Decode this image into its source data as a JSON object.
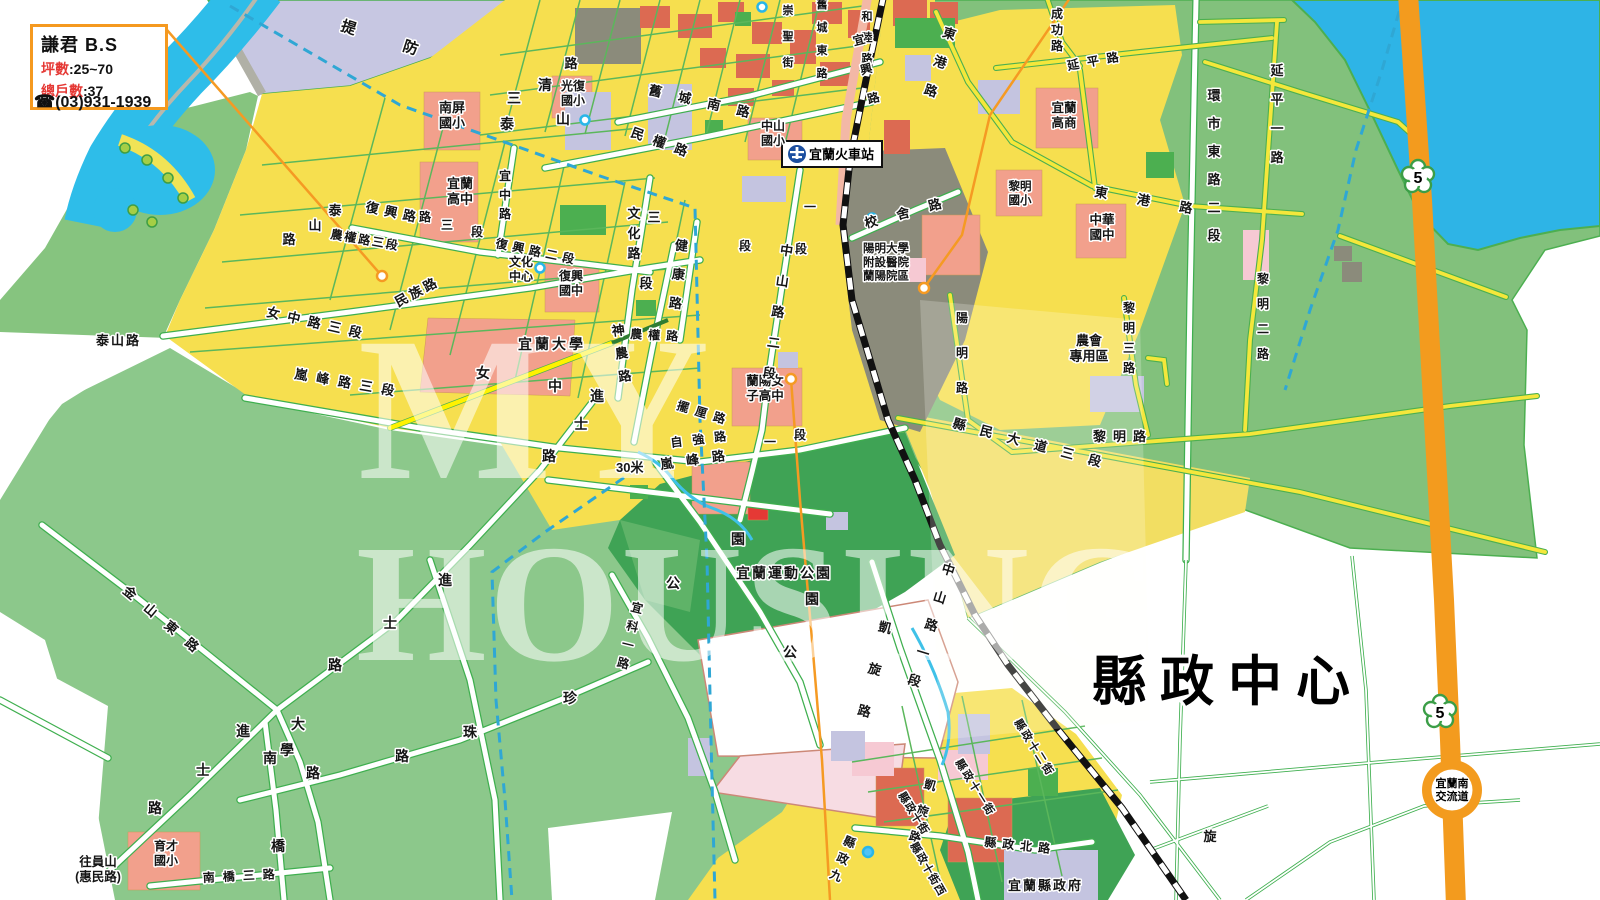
{
  "info_box": {
    "title": "謙君 B.S",
    "area_label": "坪數",
    "area_sep": ":",
    "area_value": "25~70",
    "units_label": "總戶數",
    "units_sep": ":",
    "units_value": "37",
    "phone_icon": "☎",
    "phone": "(03)931-1939"
  },
  "station": {
    "label": "宜蘭火車站"
  },
  "district_label": "縣政中心",
  "highway": {
    "number": "5",
    "interchange_line1": "宜蘭南",
    "interchange_line2": "交流道"
  },
  "watermark": {
    "line1": "MY",
    "line2": "HOUSING"
  },
  "colors": {
    "accent_orange": "#F5991F",
    "label_red": "#E53935",
    "water": "#2EBDE9",
    "field_green": "#8CC88B",
    "park_green": "#3FA355",
    "urban_yellow": "#F6DF4F",
    "school_red": "#DC6A52",
    "highway_orange": "#F39B1E"
  },
  "labels": [
    {
      "t": "提防",
      "x": 340,
      "y": 30,
      "s": 15,
      "a": 18,
      "sp": 50
    },
    {
      "t": "南屏\n國小",
      "x": 452,
      "y": 112,
      "s": 13,
      "an": "m"
    },
    {
      "t": "光復\n國小",
      "x": 573,
      "y": 90,
      "s": 12,
      "an": "m"
    },
    {
      "t": "清",
      "x": 545,
      "y": 90,
      "s": 14,
      "an": "m"
    },
    {
      "t": "路",
      "x": 571,
      "y": 68,
      "s": 13,
      "an": "m"
    },
    {
      "t": "三",
      "x": 514,
      "y": 103,
      "s": 14,
      "an": "m"
    },
    {
      "t": "泰",
      "x": 507,
      "y": 129,
      "s": 14,
      "an": "m"
    },
    {
      "t": "山",
      "x": 563,
      "y": 124,
      "s": 14,
      "an": "m"
    },
    {
      "t": "舊城南路",
      "x": 648,
      "y": 94,
      "a": 13,
      "sp": 17
    },
    {
      "t": "民權路",
      "x": 630,
      "y": 136,
      "a": 20,
      "sp": 10
    },
    {
      "t": "中山\n國小",
      "x": 773,
      "y": 130,
      "s": 12,
      "an": "m"
    },
    {
      "t": "崇聖街",
      "x": 788,
      "y": 14,
      "v": 1,
      "st": 26,
      "s": 11
    },
    {
      "t": "舊城東路",
      "x": 822,
      "y": 8,
      "v": 1,
      "st": 23,
      "s": 11
    },
    {
      "t": "和睦路",
      "x": 867,
      "y": 20,
      "v": 1,
      "st": 21,
      "s": 11
    },
    {
      "t": "宜興路",
      "x": 860,
      "y": 44,
      "v": 1,
      "st": 30,
      "s": 12,
      "a": -14
    },
    {
      "t": "東港路",
      "x": 948,
      "y": 38,
      "v": 1,
      "st": 30,
      "s": 13,
      "a": 18
    },
    {
      "t": "成功路",
      "x": 1057,
      "y": 18,
      "v": 1,
      "st": 16,
      "s": 12
    },
    {
      "t": "延平路",
      "x": 1068,
      "y": 70,
      "a": -10,
      "sp": 8,
      "s": 12
    },
    {
      "t": "宜蘭\n高商",
      "x": 1064,
      "y": 112,
      "s": 12.5,
      "an": "m"
    },
    {
      "t": "黎明\n國小",
      "x": 1020,
      "y": 190,
      "s": 11.5,
      "an": "m"
    },
    {
      "t": "中華\n國中",
      "x": 1102,
      "y": 224,
      "s": 12.5,
      "an": "m"
    },
    {
      "t": "東港路",
      "x": 1094,
      "y": 196,
      "a": 10,
      "sp": 30
    },
    {
      "t": "環市東路二段",
      "x": 1214,
      "y": 100,
      "v": 1,
      "st": 28,
      "s": 13
    },
    {
      "t": "延平一路",
      "x": 1277,
      "y": 75,
      "v": 1,
      "st": 29,
      "s": 13
    },
    {
      "t": "黎明二路",
      "x": 1263,
      "y": 283,
      "v": 1,
      "st": 25,
      "s": 12
    },
    {
      "t": "黎明三路",
      "x": 1129,
      "y": 312,
      "v": 1,
      "st": 20,
      "s": 12
    },
    {
      "t": "農會\n專用區",
      "x": 1089,
      "y": 345,
      "s": 13,
      "an": "m"
    },
    {
      "t": "陽明路",
      "x": 962,
      "y": 322,
      "v": 1,
      "st": 35,
      "s": 12
    },
    {
      "t": "校舍路",
      "x": 866,
      "y": 228,
      "a": -15,
      "sp": 20
    },
    {
      "t": "陽明大學\n附設醫院\n蘭陽院區",
      "x": 886,
      "y": 252,
      "s": 11.5,
      "an": "m"
    },
    {
      "t": "縣民大道三段",
      "x": 952,
      "y": 427,
      "a": 15,
      "sp": 15
    },
    {
      "t": "黎明路",
      "x": 1093,
      "y": 441,
      "sp": 7
    },
    {
      "t": "宜蘭\n高中",
      "x": 460,
      "y": 188,
      "s": 13,
      "an": "m"
    },
    {
      "t": "路",
      "x": 425,
      "y": 221,
      "s": 12,
      "an": "m"
    },
    {
      "t": "三",
      "x": 447,
      "y": 229,
      "s": 12,
      "an": "m"
    },
    {
      "t": "段",
      "x": 477,
      "y": 236,
      "s": 12,
      "an": "m"
    },
    {
      "t": "宜中路",
      "x": 505,
      "y": 180,
      "v": 1,
      "st": 19,
      "s": 12
    },
    {
      "t": "復興路",
      "x": 365,
      "y": 211,
      "a": 12,
      "sp": 6
    },
    {
      "t": "泰",
      "x": 335,
      "y": 215,
      "s": 13,
      "an": "m"
    },
    {
      "t": "山",
      "x": 315,
      "y": 230,
      "s": 13,
      "an": "m"
    },
    {
      "t": "路",
      "x": 289,
      "y": 244,
      "s": 13,
      "an": "m"
    },
    {
      "t": "農權路三段",
      "x": 330,
      "y": 238,
      "a": 10,
      "sp": 2,
      "s": 12
    },
    {
      "t": "民族路",
      "x": 398,
      "y": 307,
      "a": -28,
      "sp": 3
    },
    {
      "t": "女中路三段",
      "x": 266,
      "y": 316,
      "a": 13,
      "sp": 8
    },
    {
      "t": "嵐峰路三段",
      "x": 294,
      "y": 378,
      "a": 10,
      "sp": 9
    },
    {
      "t": "女",
      "x": 483,
      "y": 378,
      "s": 14,
      "an": "m"
    },
    {
      "t": "中",
      "x": 555,
      "y": 391,
      "s": 14,
      "an": "m"
    },
    {
      "t": "進",
      "x": 597,
      "y": 401,
      "s": 14,
      "an": "m"
    },
    {
      "t": "士",
      "x": 581,
      "y": 429,
      "s": 14,
      "an": "m"
    },
    {
      "t": "路",
      "x": 549,
      "y": 461,
      "s": 14,
      "an": "m"
    },
    {
      "t": "文化\n中心",
      "x": 521,
      "y": 266,
      "s": 12,
      "an": "m"
    },
    {
      "t": "復興\n國中",
      "x": 571,
      "y": 280,
      "s": 12,
      "an": "m"
    },
    {
      "t": "復興路二段",
      "x": 495,
      "y": 247,
      "a": 12,
      "sp": 5,
      "s": 12
    },
    {
      "t": "文化路",
      "x": 634,
      "y": 218,
      "v": 1,
      "st": 20,
      "s": 13
    },
    {
      "t": "三",
      "x": 654,
      "y": 222,
      "s": 13,
      "an": "m"
    },
    {
      "t": "段",
      "x": 646,
      "y": 288,
      "s": 13,
      "an": "m"
    },
    {
      "t": "健康路",
      "x": 681,
      "y": 250,
      "v": 1,
      "st": 29,
      "s": 13,
      "a": 6
    },
    {
      "t": "宜蘭大學",
      "x": 518,
      "y": 349,
      "s": 14,
      "sp": 3
    },
    {
      "t": "神農路",
      "x": 619,
      "y": 335,
      "v": 1,
      "st": 23,
      "s": 13,
      "a": -8
    },
    {
      "t": "農權路",
      "x": 630,
      "y": 338,
      "a": 3,
      "sp": 6,
      "s": 12
    },
    {
      "t": "蘭陽女\n子高中",
      "x": 765,
      "y": 385,
      "s": 12.5,
      "an": "m"
    },
    {
      "t": "擺厘路",
      "x": 676,
      "y": 409,
      "a": 17,
      "sp": 7,
      "s": 12
    },
    {
      "t": "自強路",
      "x": 671,
      "y": 447,
      "a": -7,
      "sp": 10,
      "s": 12
    },
    {
      "t": "嵐峰路",
      "x": 661,
      "y": 469,
      "a": -8,
      "sp": 13
    },
    {
      "t": "一",
      "x": 770,
      "y": 446,
      "s": 12,
      "an": "m"
    },
    {
      "t": "段",
      "x": 800,
      "y": 439,
      "s": 12,
      "an": "m"
    },
    {
      "t": "30米",
      "x": 616,
      "y": 472,
      "s": 13
    },
    {
      "t": "中山路二段",
      "x": 786,
      "y": 255,
      "v": 1,
      "st": 31,
      "s": 13,
      "a": 8
    },
    {
      "t": "一",
      "x": 810,
      "y": 211,
      "s": 12,
      "an": "m"
    },
    {
      "t": "段",
      "x": 801,
      "y": 253,
      "s": 12,
      "an": "m"
    },
    {
      "t": "段",
      "x": 745,
      "y": 250,
      "s": 12,
      "an": "m"
    },
    {
      "t": "宜蘭運動公園",
      "x": 736,
      "y": 578,
      "s": 14,
      "sp": 2
    },
    {
      "t": "園",
      "x": 738,
      "y": 544,
      "s": 14,
      "an": "m"
    },
    {
      "t": "公",
      "x": 673,
      "y": 588,
      "s": 14,
      "an": "m"
    },
    {
      "t": "園",
      "x": 812,
      "y": 604,
      "s": 14,
      "an": "m"
    },
    {
      "t": "公",
      "x": 790,
      "y": 657,
      "s": 14,
      "an": "m"
    },
    {
      "t": "凱旋路",
      "x": 884,
      "y": 632,
      "v": 1,
      "st": 43,
      "s": 13,
      "a": 14
    },
    {
      "t": "凱旋路",
      "x": 929,
      "y": 789,
      "v": 1,
      "st": 27,
      "s": 12,
      "a": 16
    },
    {
      "t": "中山路一段",
      "x": 947,
      "y": 574,
      "v": 1,
      "st": 29,
      "s": 13,
      "a": 17
    },
    {
      "t": "縣政十一街",
      "x": 955,
      "y": 762,
      "a": 58,
      "sp": 2,
      "s": 11
    },
    {
      "t": "縣政十二街",
      "x": 1014,
      "y": 722,
      "a": 58,
      "sp": 2,
      "s": 11
    },
    {
      "t": "縣政十街",
      "x": 898,
      "y": 795,
      "a": 58,
      "sp": 1,
      "s": 11
    },
    {
      "t": "縣政十街西",
      "x": 910,
      "y": 845,
      "a": 60,
      "sp": 1,
      "s": 11
    },
    {
      "t": "縣政北路",
      "x": 984,
      "y": 846,
      "a": 6,
      "sp": 6,
      "s": 12
    },
    {
      "t": "縣政九",
      "x": 848,
      "y": 846,
      "v": 1,
      "st": 18,
      "s": 12,
      "a": 22
    },
    {
      "t": "宜蘭縣政府",
      "x": 1008,
      "y": 890,
      "s": 13,
      "sp": 2
    },
    {
      "t": "旋",
      "x": 1210,
      "y": 841,
      "s": 13,
      "an": "m"
    },
    {
      "t": "金山東路",
      "x": 122,
      "y": 592,
      "a": 40,
      "sp": 14
    },
    {
      "t": "進",
      "x": 445,
      "y": 585,
      "s": 14,
      "an": "m"
    },
    {
      "t": "士",
      "x": 390,
      "y": 628,
      "s": 14,
      "an": "m"
    },
    {
      "t": "路",
      "x": 335,
      "y": 670,
      "s": 14,
      "an": "m"
    },
    {
      "t": "進",
      "x": 243,
      "y": 736,
      "s": 14,
      "an": "m"
    },
    {
      "t": "士",
      "x": 203,
      "y": 775,
      "s": 14,
      "an": "m"
    },
    {
      "t": "路",
      "x": 155,
      "y": 813,
      "s": 14,
      "an": "m"
    },
    {
      "t": "大",
      "x": 298,
      "y": 729,
      "s": 14,
      "an": "m"
    },
    {
      "t": "學",
      "x": 287,
      "y": 755,
      "s": 14,
      "an": "m"
    },
    {
      "t": "路",
      "x": 313,
      "y": 778,
      "s": 14,
      "an": "m"
    },
    {
      "t": "南",
      "x": 270,
      "y": 763,
      "s": 14,
      "an": "m"
    },
    {
      "t": "橋",
      "x": 278,
      "y": 851,
      "s": 14,
      "an": "m"
    },
    {
      "t": "南橋三路",
      "x": 203,
      "y": 882,
      "sp": 8,
      "s": 12,
      "a": -3
    },
    {
      "t": "育才\n國小",
      "x": 166,
      "y": 850,
      "s": 12,
      "an": "m"
    },
    {
      "t": "往員山\n(惠民路)",
      "x": 98,
      "y": 866,
      "s": 12.5,
      "an": "m"
    },
    {
      "t": "珍",
      "x": 570,
      "y": 703,
      "s": 14,
      "an": "m"
    },
    {
      "t": "珠",
      "x": 470,
      "y": 737,
      "s": 14,
      "an": "m"
    },
    {
      "t": "路",
      "x": 402,
      "y": 761,
      "s": 14,
      "an": "m"
    },
    {
      "t": "宜科一路",
      "x": 636,
      "y": 612,
      "v": 1,
      "st": 19,
      "s": 12,
      "a": 14
    },
    {
      "t": "泰山路",
      "x": 96,
      "y": 345,
      "s": 13,
      "sp": 2
    }
  ]
}
